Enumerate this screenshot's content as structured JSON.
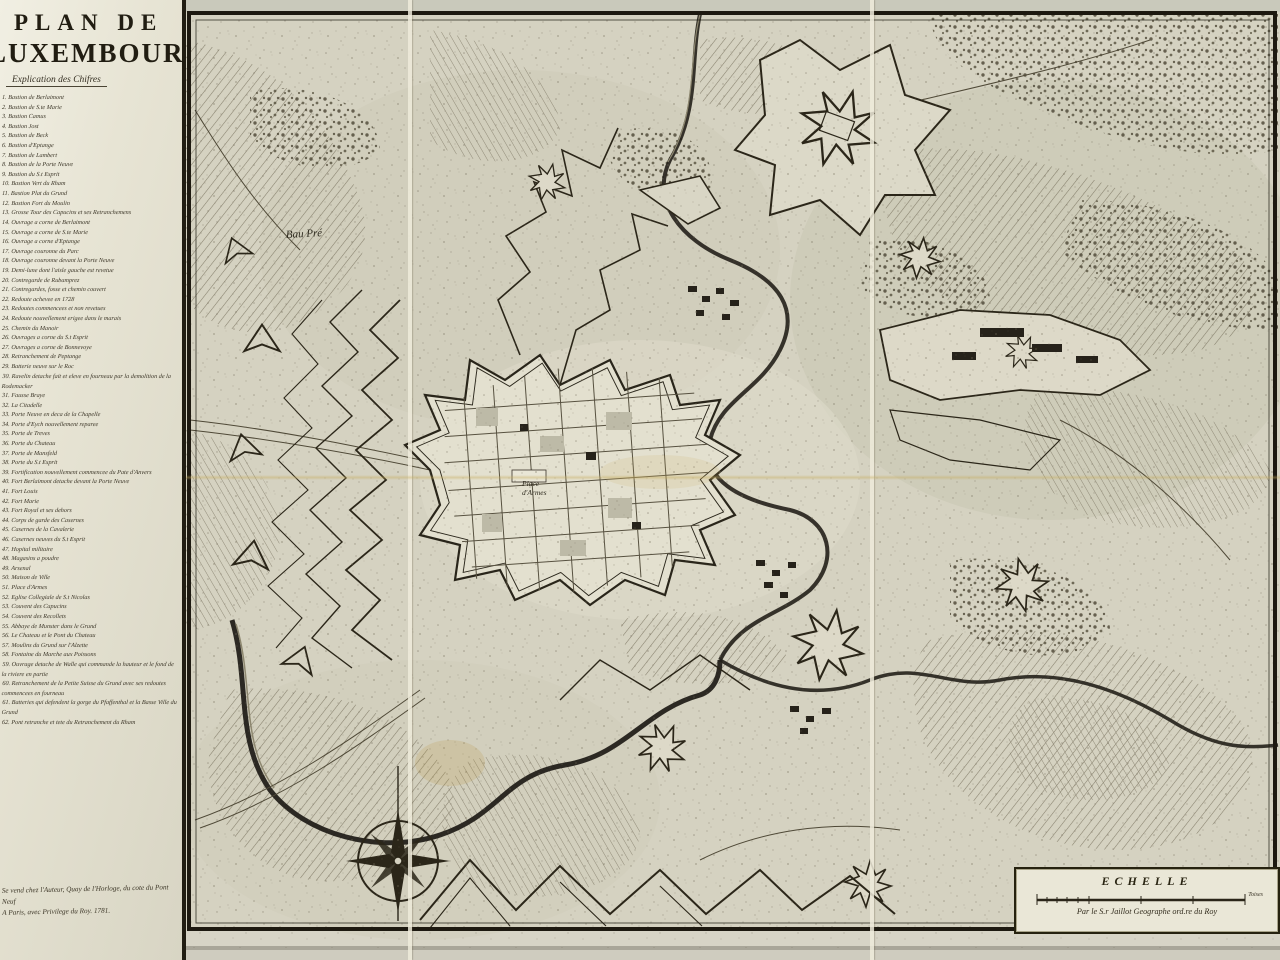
{
  "document": {
    "type": "engraved-fortification-map",
    "sheet_color": "#d5d2c1",
    "ink_color": "#2b2619"
  },
  "title_block": {
    "line1": "PLAN DE",
    "line2": "LUXEMBOURG",
    "subtitle": "Explication des Chifres"
  },
  "legend": {
    "items": [
      "1. Bastion de Berlaimont",
      "2. Bastion de S.te Marie",
      "3. Bastion Camus",
      "4. Bastion Jost",
      "5. Bastion de Beck",
      "6. Bastion d'Eptange",
      "7. Bastion de Lambert",
      "8. Bastion de la Porte Neuve",
      "9. Bastion du S.t Esprit",
      "10. Bastion Vert du Rham",
      "11. Bastion Plat du Grund",
      "12. Bastion Fort du Moulin",
      "13. Grosse Tour des Capucins et ses Retranchemens",
      "14. Ouvrage a corne de Berlaimont",
      "15. Ouvrage a corne de S.te Marie",
      "16. Ouvrage a corne d'Eptange",
      "17. Ouvrage couronne du Parc",
      "18. Ouvrage couronne devant la Porte Neuve",
      "19. Demi-lune dont l'aisle gauche est revetue",
      "20. Contregarde de Rubamprez",
      "21. Contregardes, fosse et chemin couvert",
      "22. Redoute achevee en 1728",
      "23. Redoutes commencees et non revetues",
      "24. Redoute nouvellement erigee dans le marais",
      "25. Chemin du Manoir",
      "26. Ouvrages a corne du S.t Esprit",
      "27. Ouvrages a corne de Bonnevoye",
      "28. Retranchement de Peptange",
      "29. Batterie neuve sur le Roc",
      "30. Ravelin detache fait et eleve en fourneau par la demolition de la Rodemacker",
      "31. Fausse Braye",
      "32. La Citadelle",
      "33. Porte Neuve en deca de la Chapelle",
      "34. Porte d'Eych nouvellement reparee",
      "35. Porte de Treves",
      "36. Porte du Chateau",
      "37. Porte de Mansfeld",
      "38. Porte du S.t Esprit",
      "39. Fortification nouvellement commencee du Pate d'Anvers",
      "40. Fort Berlaimont detache devant la Porte Neuve",
      "41. Fort Louis",
      "42. Fort Marie",
      "43. Fort Royal et ses dehors",
      "44. Corps de garde des Casernes",
      "45. Casernes de la Cavalerie",
      "46. Casernes neuves du S.t Esprit",
      "47. Hopital militaire",
      "48. Magasins a poudre",
      "49. Arsenal",
      "50. Maison de Ville",
      "51. Place d'Armes",
      "52. Eglise Collegiale de S.t Nicolas",
      "53. Couvent des Capucins",
      "54. Couvent des Recollets",
      "55. Abbaye de Munster dans le Grund",
      "56. Le Chateau et le Pont du Chateau",
      "57. Moulins du Grund sur l'Alzette",
      "58. Fontaine du Marche aux Poissons",
      "59. Ouvrage detache de Walle qui commande la hauteur et le fond de la riviere en partie",
      "60. Retranchement de la Petite Suisse du Grund avec ses redoutes commencees en fourneau",
      "61. Batteries qui defendent la gorge du Pfaffenthal et la Basse Ville du Grund",
      "62. Pont retranche et tete du Retranchement du Rham"
    ]
  },
  "imprint": {
    "line1": "Se vend chez l'Auteur, Quay de l'Horloge, du cote du Pont Neuf",
    "line2": "A Paris, avec Privilege du Roy. 1781."
  },
  "map_labels": {
    "bau_pre": "Bau Pré",
    "place_line1": "Place",
    "place_line2": "d'Armes"
  },
  "scale": {
    "title": "ECHELLE",
    "unit_label": "Toises",
    "caption": "Par le S.r Jaillot Geographe ord.re du Roy"
  },
  "colors": {
    "parchment": "#d5d2c1",
    "panel": "#e9e6d6",
    "ink": "#2b2619",
    "hachure": "#6b6450",
    "river": "#23201a",
    "fold_tint": "#c6ac5c"
  }
}
